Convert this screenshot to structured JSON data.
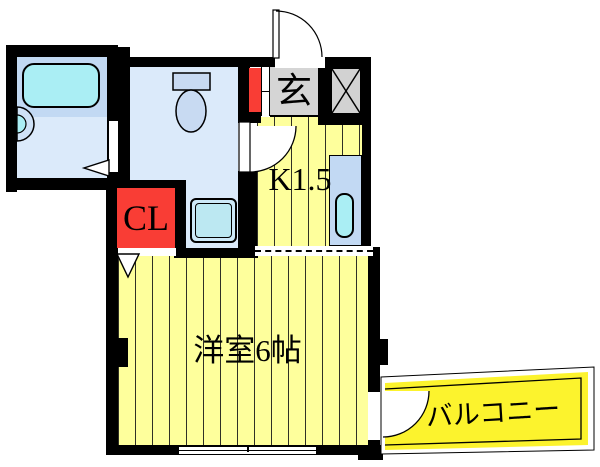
{
  "labels": {
    "entrance": "玄",
    "kitchen": "K1.5",
    "closet": "CL",
    "main_room": "洋室6帖",
    "balcony": "バルコニー"
  },
  "colors": {
    "wall": "#000000",
    "room_floor_yellow": "#feff9c",
    "balcony_yellow": "#fcf32d",
    "wet_room_floor_blue": "#dbeafa",
    "fixture_blue": "#c2d9f3",
    "water_cyan": "#aaeef4",
    "closet_red": "#f93d35",
    "entrance_gray": "#d5d5d5"
  }
}
